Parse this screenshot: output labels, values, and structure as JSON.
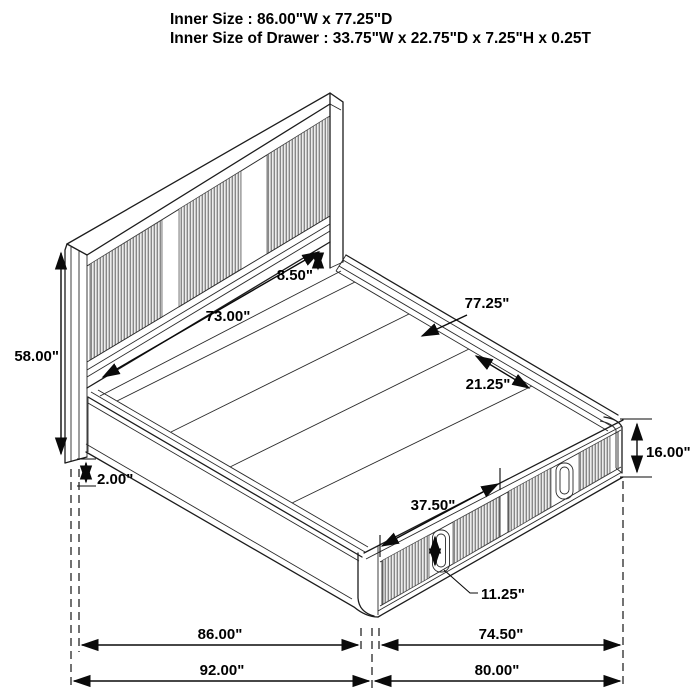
{
  "header": {
    "line1": "Inner Size : 86.00\"W x 77.25\"D",
    "line2": "Inner Size of Drawer : 33.75\"W x 22.75\"D x 7.25\"H x 0.25T"
  },
  "dimensions": {
    "headboard_panel_width": "73.00\"",
    "headboard_to_deck_gap": "8.50\"",
    "inner_depth": "77.25\"",
    "slat_section_depth": "21.25\"",
    "headboard_height": "58.00\"",
    "base_clearance": "2.00\"",
    "footboard_height": "16.00\"",
    "drawer_front_width": "37.50\"",
    "drawer_handle_height": "11.25\"",
    "inner_width": "86.00\"",
    "drawer_side_length": "74.50\"",
    "overall_width": "92.00\"",
    "overall_length": "80.00\""
  },
  "colors": {
    "line": "#1c1c1c",
    "background": "#ffffff",
    "rib_fill": "#ececec",
    "rib_line": "#707070"
  }
}
